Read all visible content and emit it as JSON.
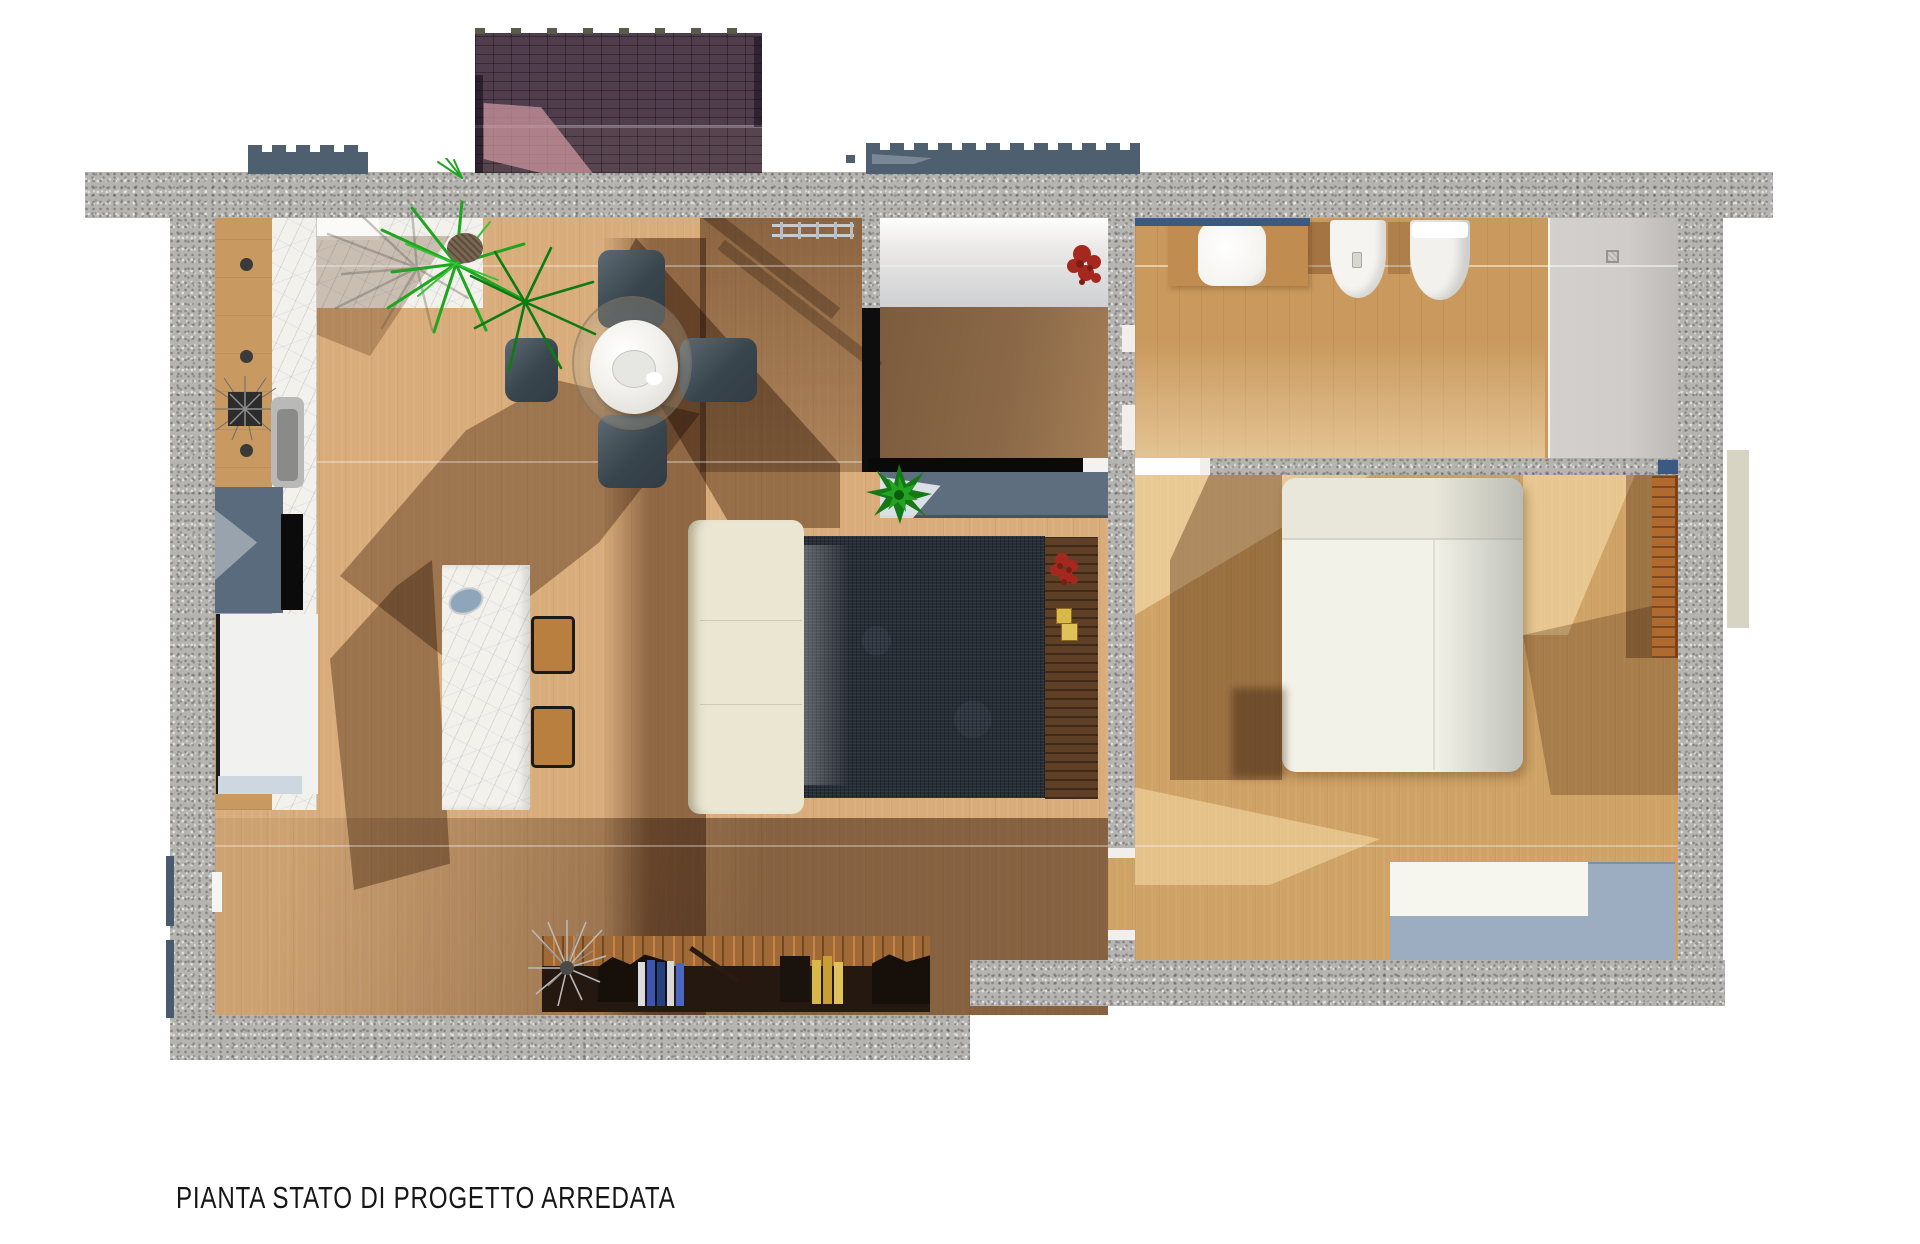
{
  "caption": "PIANTA STATO DI PROGETTO ARREDATA",
  "palette": {
    "background": "#ffffff",
    "wall_speckle": "#b5b4b1",
    "wood_living": "#d9ad7b",
    "wood_bedroom": "#cfa265",
    "wood_bathroom": "#c9995e",
    "marble_white": "#f3f1ec",
    "shadow_brown": "#5c3a1c",
    "rug_dark": "#272d36",
    "sofa_cream": "#eae6d1",
    "roof_purple": "#4f3d4d",
    "roof_pink_light": "#c9949e",
    "window_slate": "#4e5f70",
    "sill_blue": "#3a5a82",
    "bed_white": "#f3f2e8",
    "dresser_blue": "#9cadc2",
    "wardrobe_orange": "#b06a30",
    "plant_green": "#1fa51f",
    "flower_red": "#a5281e",
    "books_blue": "#3a56b0",
    "books_yellow": "#d9b84a",
    "shower_gray": "#cfccc9"
  },
  "furniture": [
    "dining-table",
    "pendant-lamp",
    "dining-chairs",
    "kitchen-counter",
    "kitchen-sink",
    "cooktop",
    "refrigerator",
    "kitchen-island",
    "bar-stools",
    "sofa",
    "area-rug",
    "tv-console",
    "sideboard-bench",
    "bookshelf",
    "double-bed",
    "dresser",
    "wardrobe",
    "washbasin",
    "bidet",
    "toilet",
    "shower",
    "clothes-rack",
    "palm-plant",
    "potted-plants",
    "roof-canopy",
    "window-frames"
  ]
}
